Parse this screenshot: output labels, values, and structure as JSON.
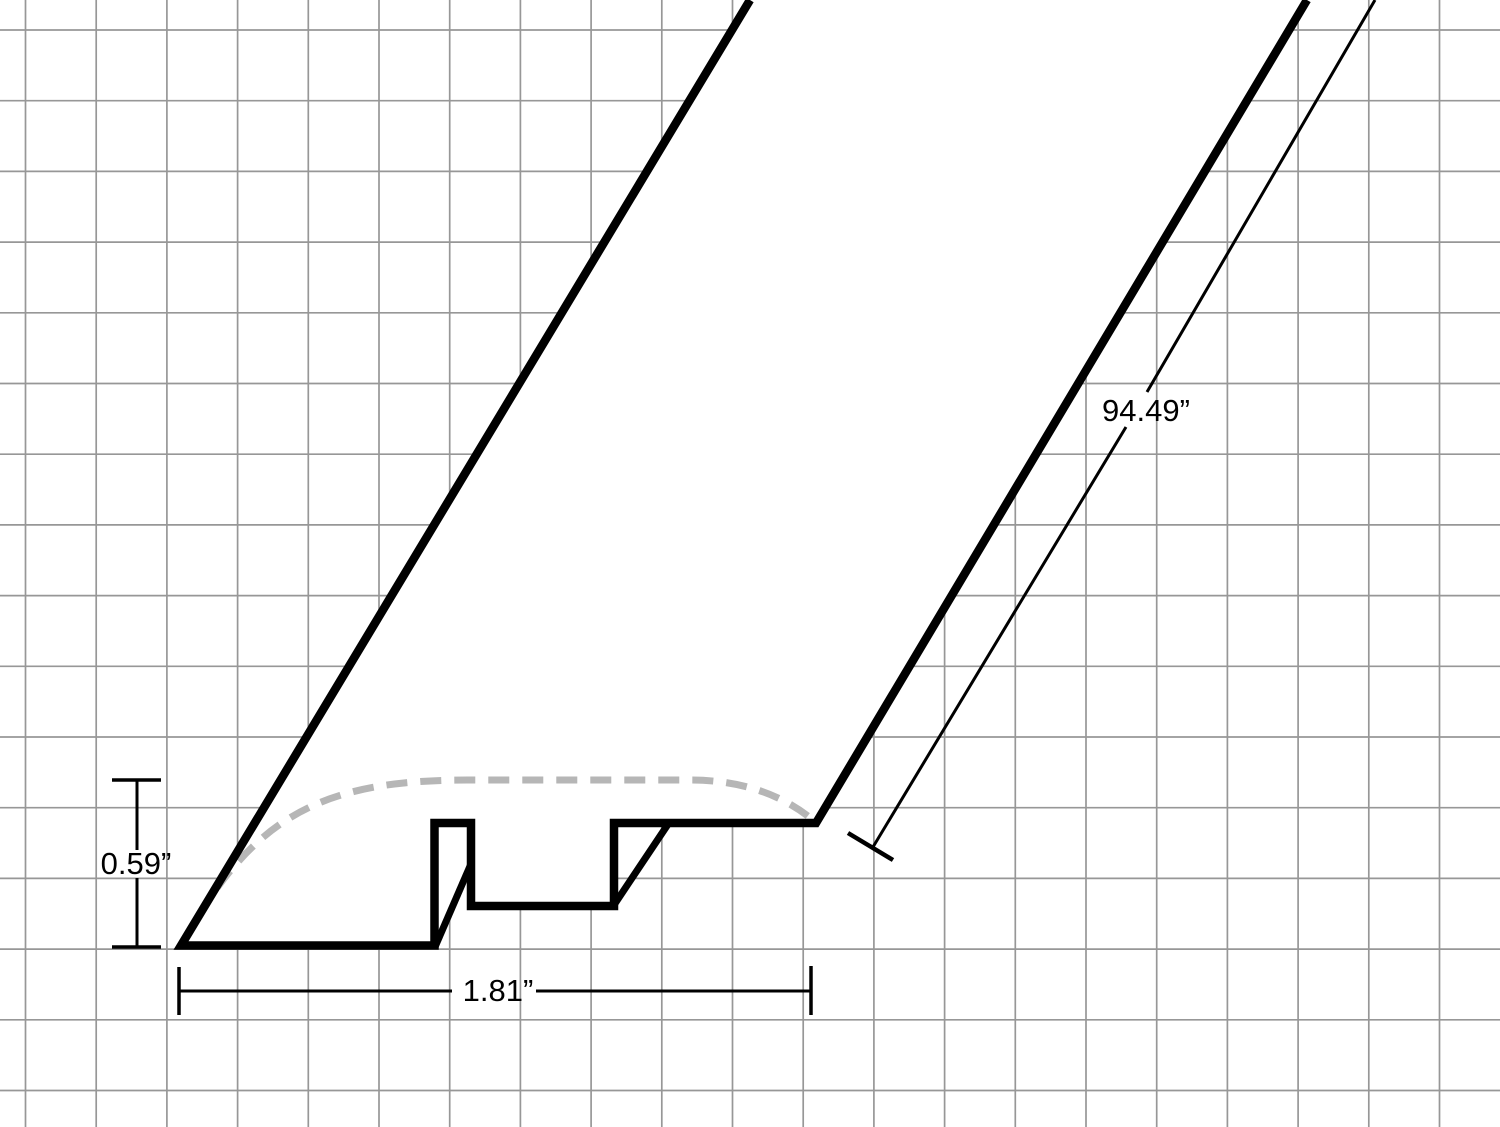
{
  "diagram": {
    "title": "Reducer molding profile dimension drawing",
    "dimension_labels": {
      "height": "0.59”",
      "width": "1.81”",
      "length": "94.49”"
    },
    "dimensions": [
      {
        "name": "height",
        "label": "0.59”",
        "value": 0.59,
        "unit": "inches"
      },
      {
        "name": "width",
        "label": "1.81”",
        "value": 1.81,
        "unit": "inches"
      },
      {
        "name": "length",
        "label": "94.49”",
        "value": 94.49,
        "unit": "inches"
      }
    ],
    "colors": {
      "outline": "#000000",
      "grid_line": "#979797",
      "profile_curve": "#b6b6b6",
      "dimension_line": "#000000",
      "background": "#ffffff"
    }
  }
}
